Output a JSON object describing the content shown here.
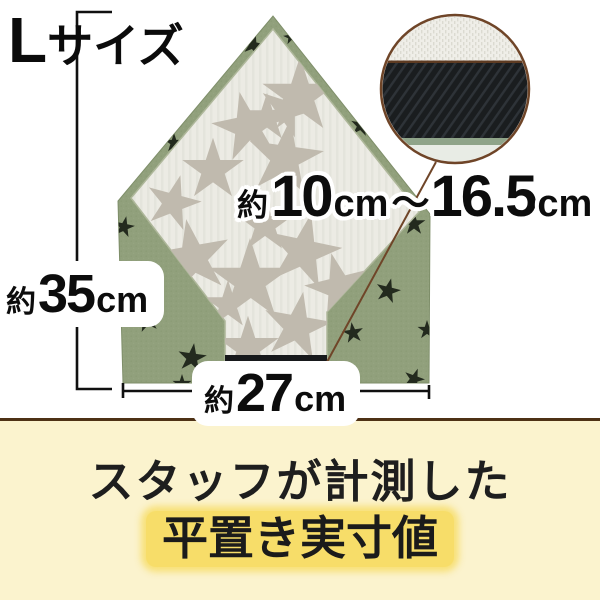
{
  "size_tag": {
    "letter": "L",
    "text": "サイズ"
  },
  "labels": {
    "band": {
      "approx": "約",
      "min": "10",
      "min_unit": "cm",
      "tilde": "〜",
      "max": "16.5",
      "max_unit": "cm"
    },
    "height": {
      "approx": "約",
      "value": "35",
      "unit": "cm"
    },
    "width": {
      "approx": "約",
      "value": "27",
      "unit": "cm"
    }
  },
  "footer": {
    "line1": "スタッフが計測した",
    "line2": "平置き実寸値"
  },
  "colors": {
    "fabric_green": "#91A07C",
    "fabric_green_dark": "#86966F",
    "fabric_white": "#ECEBE4",
    "star_black": "#232A1E",
    "quilt_star_gray": "#C0BAAE",
    "elastic_black": "#17191B",
    "callout_brown": "#6F4528",
    "seam_brown": "#5E3B22",
    "callout_band_black": "#1A1D1F",
    "callout_green_strip": "#8FA489",
    "measure_line": "#101010",
    "footer_bg": "#FBF3CE",
    "footer_border": "#4E3115",
    "highlight_yellow": "#F7DD69"
  }
}
